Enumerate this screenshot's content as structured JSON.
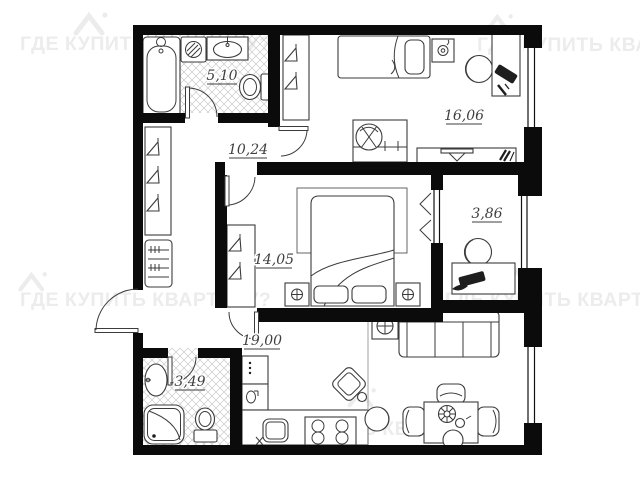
{
  "watermark": {
    "text": "ГДЕ КУПИТЬ КВАРТИРУ?",
    "color": "#ececec"
  },
  "plan": {
    "rooms": [
      {
        "id": "bathroom",
        "label": "5,10"
      },
      {
        "id": "hallway",
        "label": "10,24"
      },
      {
        "id": "bedroom-1",
        "label": "16,06"
      },
      {
        "id": "bedroom-2",
        "label": "14,05"
      },
      {
        "id": "balcony",
        "label": "3,86"
      },
      {
        "id": "living-kitchen",
        "label": "19,00"
      },
      {
        "id": "bathroom-2",
        "label": "3,49"
      }
    ],
    "colors": {
      "walls": "#0b0b0b",
      "furniture": "#3b3b3b",
      "tiles": "#cbcbcb",
      "labels": "#3f3f3f",
      "background": "#ffffff",
      "watermark": "#ececec"
    }
  }
}
